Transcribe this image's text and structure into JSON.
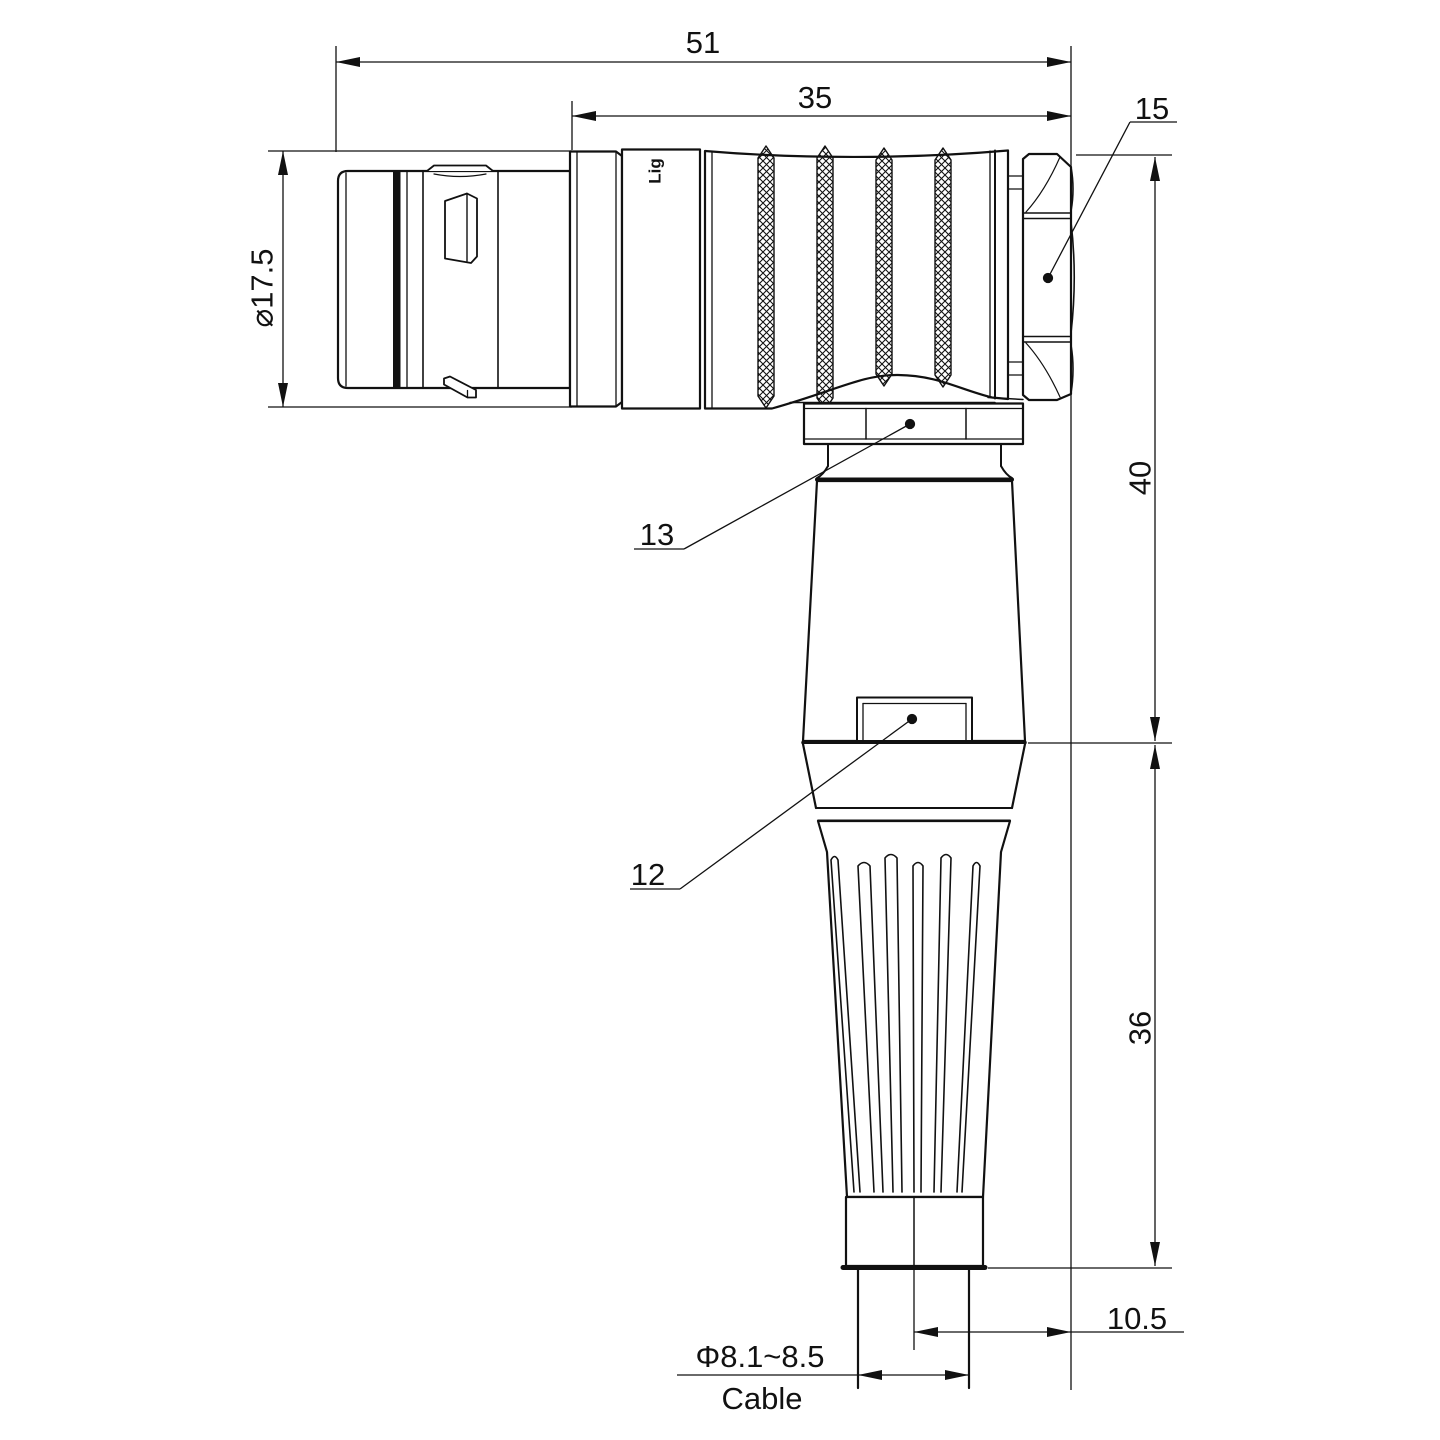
{
  "drawing": {
    "watermark": "Lightany",
    "body_print": "Lig",
    "dimensions": {
      "overall_length": "51",
      "grip_length": "35",
      "front_diameter": "⌀17.5",
      "height_upper": "40",
      "height_lower": "36",
      "cable_offset": "10.5",
      "cable_diameter": "Φ8.1~8.5",
      "cable_label": "Cable"
    },
    "callouts": {
      "back_hex_nut": "15",
      "coupling_nut": "13",
      "boot_tab": "12"
    },
    "colors": {
      "line": "#111111",
      "watermark": "#f6cdcd",
      "background": "#ffffff"
    }
  }
}
